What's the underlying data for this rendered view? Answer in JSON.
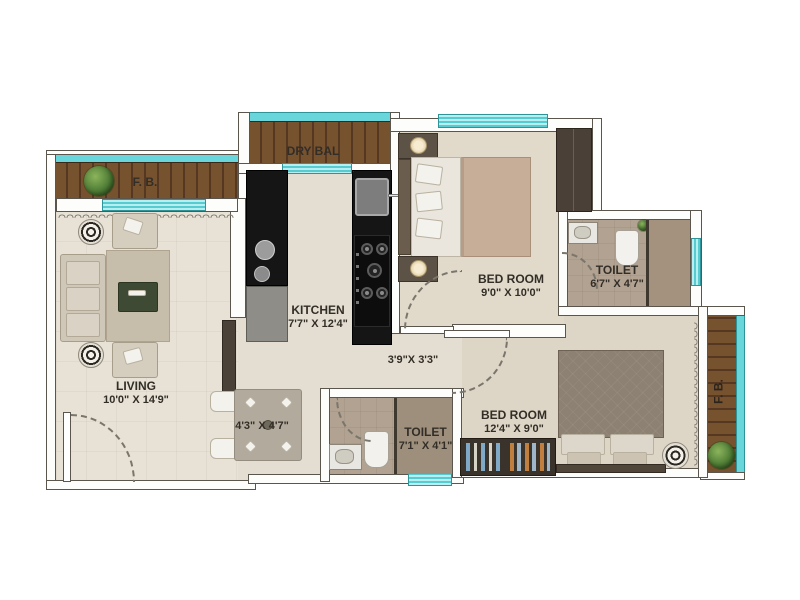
{
  "rooms": {
    "fb_left": {
      "label": "F. B."
    },
    "dry_bal": {
      "label": "DRY BAL"
    },
    "kitchen": {
      "label": "KITCHEN",
      "dims": "7'7\" X 12'4\""
    },
    "bedroom_top": {
      "label": "BED ROOM",
      "dims": "9'0\" X 10'0\""
    },
    "toilet_top": {
      "label": "TOILET",
      "dims": "6'7\" X 4'7\""
    },
    "passage": {
      "dims": "3'9\"X 3'3\""
    },
    "living": {
      "label": "LIVING",
      "dims": "10'0\" X 14'9\""
    },
    "dining": {
      "dims": "4'3\" X 4'7\""
    },
    "toilet_bottom": {
      "label": "TOILET",
      "dims": "7'1\" X 4'1\""
    },
    "bedroom_bottom": {
      "label": "BED ROOM",
      "dims": "12'4\" X 9'0\""
    },
    "fb_right": {
      "label": "F. B."
    }
  },
  "colors": {
    "glass": "#68d6da",
    "wood": "#77522f",
    "counter": "#151515",
    "floor": "#e7e1d6",
    "wet_floor": "#b2a291",
    "wall": "#fdfdfc",
    "outline": "#5a564e",
    "label_text": "#322e27"
  }
}
